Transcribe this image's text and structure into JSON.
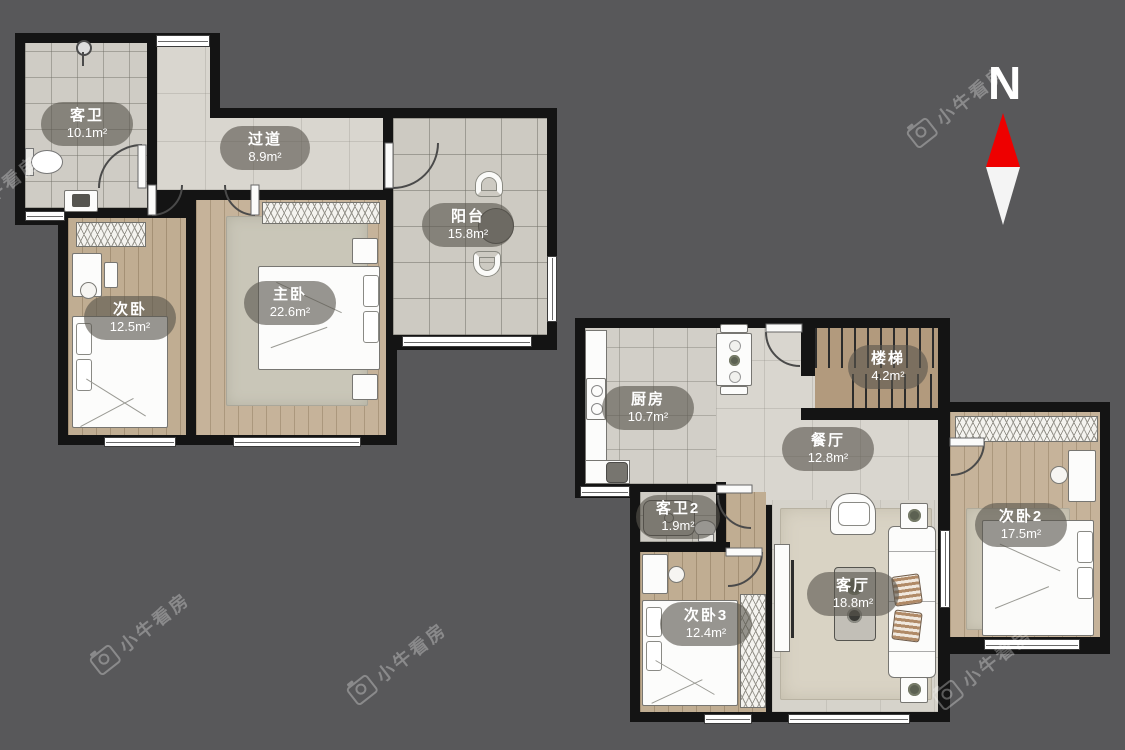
{
  "meta": {
    "app": "小牛看房户型图",
    "background_color": "#58585a",
    "wall_color": "#141414",
    "north_arrow_red": "#ee0000"
  },
  "north": {
    "label": "N"
  },
  "watermark": {
    "text": "小牛看房"
  },
  "rooms": {
    "kewei": {
      "name": "客卫",
      "area": "10.1m²"
    },
    "guodao": {
      "name": "过道",
      "area": "8.9m²"
    },
    "yangtai": {
      "name": "阳台",
      "area": "15.8m²"
    },
    "ciwo": {
      "name": "次卧",
      "area": "12.5m²"
    },
    "zhuwo": {
      "name": "主卧",
      "area": "22.6m²"
    },
    "chufang": {
      "name": "厨房",
      "area": "10.7m²"
    },
    "louti": {
      "name": "楼梯",
      "area": "4.2m²"
    },
    "canting": {
      "name": "餐厅",
      "area": "12.8m²"
    },
    "kewei2": {
      "name": "客卫2",
      "area": "1.9m²"
    },
    "ciwo3": {
      "name": "次卧3",
      "area": "12.4m²"
    },
    "keting": {
      "name": "客厅",
      "area": "18.8m²"
    },
    "ciwo2": {
      "name": "次卧2",
      "area": "17.5m²"
    }
  }
}
